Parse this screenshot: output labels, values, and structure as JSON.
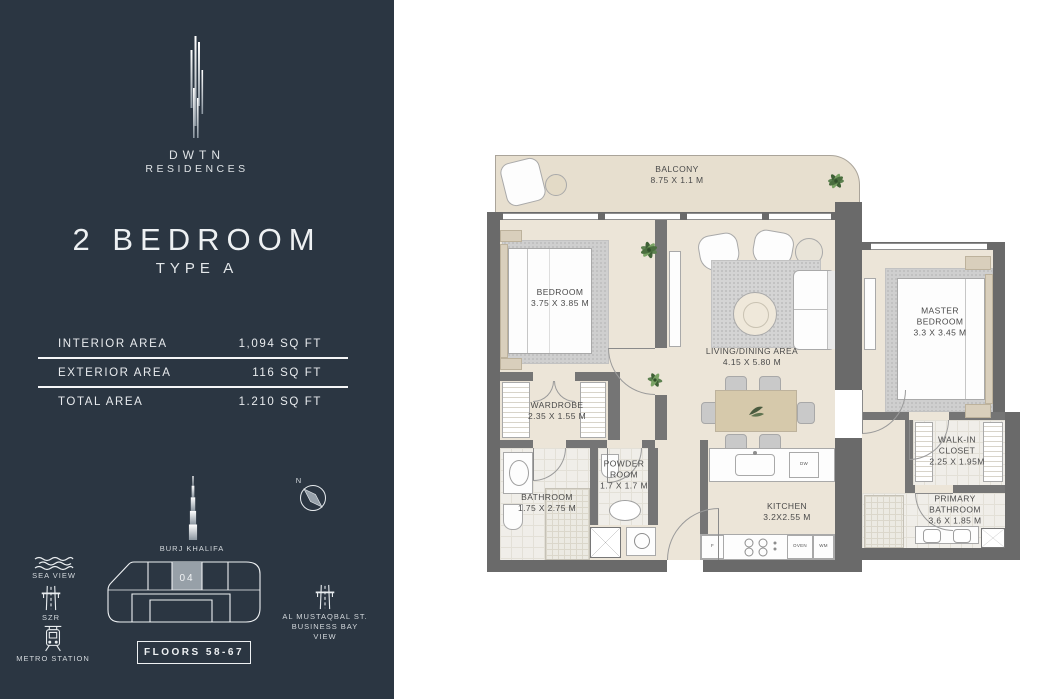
{
  "colors": {
    "sidebar_bg": "#2b3642",
    "sidebar_text": "#e8ebee",
    "wall": "#6a6a6a",
    "floor_beige": "#ece5d8",
    "balcony_beige": "#e7dfcf",
    "unit_fill": "#97a0a8"
  },
  "sidebar": {
    "brand": {
      "line1": "DWTN",
      "line2": "RESIDENCES"
    },
    "title": "2 BEDROOM",
    "subtitle": "TYPE A",
    "areas": [
      {
        "label": "INTERIOR AREA",
        "value": "1,094 SQ FT"
      },
      {
        "label": "EXTERIOR AREA",
        "value": "116 SQ FT"
      },
      {
        "label": "TOTAL AREA",
        "value": "1.210 SQ FT"
      }
    ],
    "landmarks": {
      "sea_view": "SEA VIEW",
      "szr": "SZR",
      "metro": "METRO STATION",
      "burj": "BURJ KHALIFA",
      "street_l1": "AL MUSTAQBAL ST.",
      "street_l2": "BUSINESS BAY",
      "street_l3": "VIEW",
      "compass_n": "N"
    },
    "unit_plate": {
      "unit": "04",
      "floors": "FLOORS 58-67"
    }
  },
  "floorplan": {
    "rooms": {
      "balcony": {
        "name": "BALCONY",
        "dims": "8.75 X 1.1 M"
      },
      "bedroom": {
        "name": "BEDROOM",
        "dims": "3.75 X 3.85 M"
      },
      "living": {
        "name": "LIVING/DINING AREA",
        "dims": "4.15 X 5.80 M"
      },
      "master": {
        "name": "MASTER BEDROOM",
        "dims": "3.3 X 3.45 M"
      },
      "wardrobe": {
        "name": "WARDROBE",
        "dims": "2.35 X 1.55 M"
      },
      "bathroom": {
        "name": "BATHROOM",
        "dims": "1.75 X 2.75 M"
      },
      "powder": {
        "name": "POWDER ROOM",
        "dims": "1.7 X 1.7 M"
      },
      "kitchen": {
        "name": "KITCHEN",
        "dims": "3.2X2.55 M"
      },
      "walkin": {
        "name": "WALK-IN CLOSET",
        "dims": "2.25 X 1.95M"
      },
      "primary_bath": {
        "name": "PRIMARY BATHROOM",
        "dims": "3.6 X 1.85 M"
      }
    },
    "appliances": {
      "dw": "DW",
      "f": "F",
      "oven": "OVEN",
      "wm": "WM"
    }
  }
}
